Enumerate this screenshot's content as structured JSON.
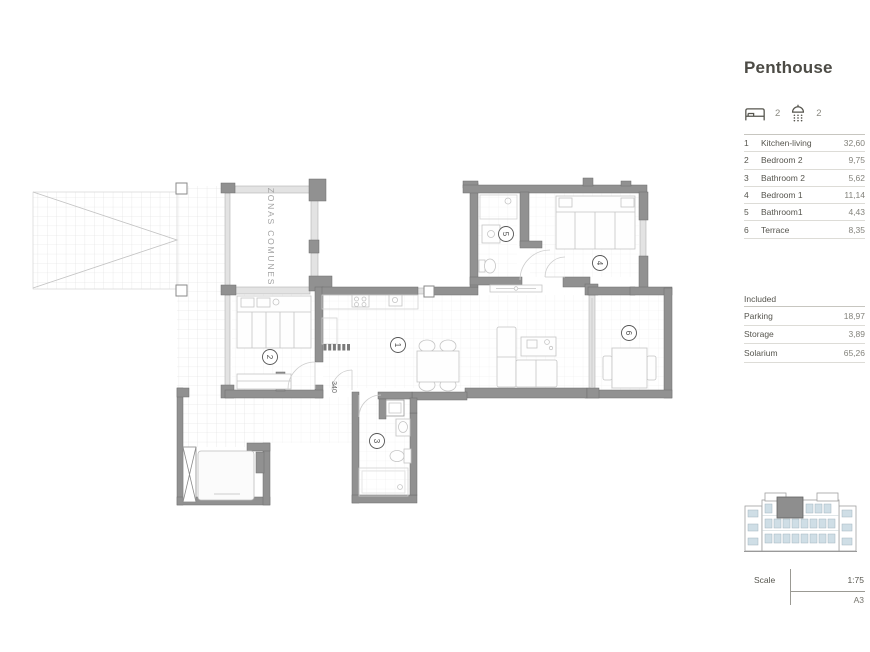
{
  "header": {
    "title": "Penthouse"
  },
  "stats": {
    "bedrooms": "2",
    "bathrooms": "2"
  },
  "rooms_table": {
    "items": [
      {
        "num": "1",
        "name": "Kitchen-living",
        "area": "32,60"
      },
      {
        "num": "2",
        "name": "Bedroom 2",
        "area": "9,75"
      },
      {
        "num": "3",
        "name": "Bathroom 2",
        "area": "5,62"
      },
      {
        "num": "4",
        "name": "Bedroom 1",
        "area": "11,14"
      },
      {
        "num": "5",
        "name": "Bathroom1",
        "area": "4,43"
      },
      {
        "num": "6",
        "name": "Terrace",
        "area": "8,35"
      }
    ]
  },
  "included_table": {
    "label": "Included",
    "items": [
      {
        "name": "Parking",
        "area": "18,97"
      },
      {
        "name": "Storage",
        "area": "3,89"
      },
      {
        "name": "Solarium",
        "area": "65,26"
      }
    ]
  },
  "plan": {
    "zone_label": "ZONAS COMUNES",
    "dimension_label": "340",
    "labels": {
      "kitchen_living": "1",
      "bedroom2": "2",
      "bathroom2": "3",
      "bedroom1": "4",
      "bathroom1": "5",
      "terrace": "6"
    }
  },
  "scale_block": {
    "label": "Scale",
    "ratio": "1:75",
    "sheet": "A3"
  },
  "colors": {
    "wall": "#919191",
    "light_wall": "#e3e3e3",
    "grid": "#e9e9e9",
    "text": "#56554e",
    "muted": "#83827b",
    "window_blue": "#cfdee6",
    "highlight_unit": "#8e8e8e"
  }
}
